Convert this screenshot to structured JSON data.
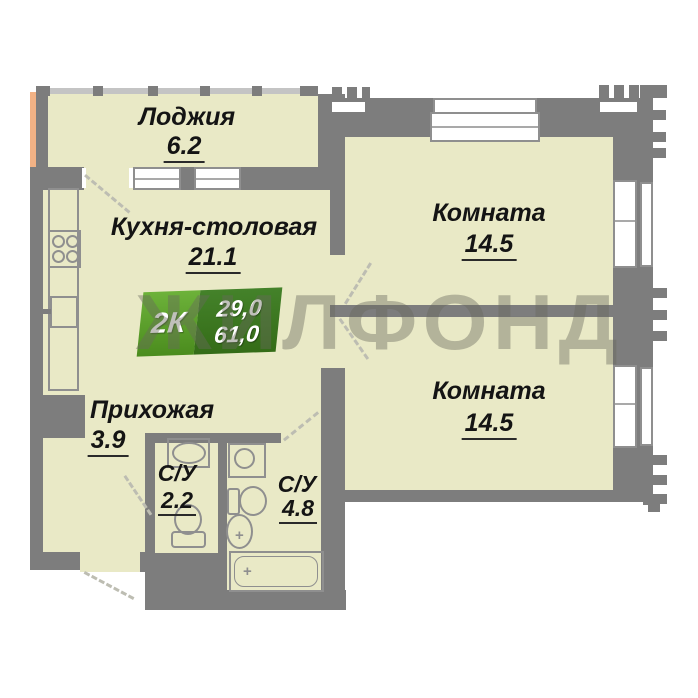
{
  "plan": {
    "watermark": "ЖИЛФОНД",
    "badge": {
      "type_label": "2К",
      "living_area": "29,0",
      "total_area": "61,0"
    },
    "rooms": [
      {
        "id": "loggia",
        "label": "Лоджия",
        "area": "6.2"
      },
      {
        "id": "kitchen",
        "label": "Кухня-столовая",
        "area": "21.1"
      },
      {
        "id": "room1",
        "label": "Комната",
        "area": "14.5"
      },
      {
        "id": "room2",
        "label": "Комната",
        "area": "14.5"
      },
      {
        "id": "hallway",
        "label": "Прихожая",
        "area": "3.9"
      },
      {
        "id": "wc_small",
        "label": "С/У",
        "area": "2.2"
      },
      {
        "id": "wc_big",
        "label": "С/У",
        "area": "4.8"
      }
    ],
    "fixtures": [
      "stove-icon",
      "kitchen-sink-icon",
      "wash-basin-icon",
      "toilet-icon",
      "washing-machine-icon",
      "bathtub-icon"
    ],
    "colors": {
      "wall": "#7d7d7d",
      "floor": "#e9e9c6",
      "badge_green_light": "#5da62c",
      "badge_green_dark": "#346c17",
      "neighbor_strip": "#f2b285",
      "watermark_gray": "rgba(104,104,94,0.42)"
    }
  }
}
